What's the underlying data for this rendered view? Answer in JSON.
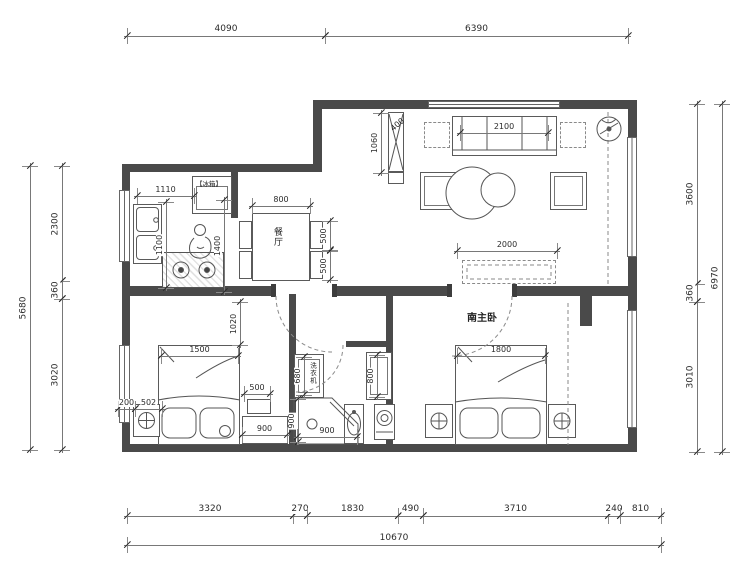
{
  "plan": {
    "type": "apartment-floor-plan",
    "labels": {
      "dining_room": "餐厅",
      "master_bedroom": "南主卧",
      "fridge": "【冰箱】",
      "washer": "洗衣机"
    },
    "dimension_chains": {
      "top": [
        "4090",
        "6390"
      ],
      "bottom_segments": [
        "3320",
        "270",
        "1830",
        "490",
        "3710",
        "240",
        "810"
      ],
      "bottom_total": "10670",
      "left_segments": [
        "2300",
        "360",
        "3020"
      ],
      "left_total": "5680",
      "right_segments": [
        "3600",
        "360",
        "3010"
      ],
      "right_total": "6970"
    },
    "interior_dimensions": [
      "1110",
      "1100",
      "1400",
      "800",
      "500",
      "500",
      "400",
      "1060",
      "2100",
      "2000",
      "1500",
      "1020",
      "200",
      "502",
      "500",
      "900",
      "1800",
      "680",
      "800",
      "900",
      "900"
    ]
  },
  "annotations": [
    {
      "id": "top-4090",
      "text": "4090",
      "type": "dh",
      "x": 127,
      "y": 36,
      "len": 198
    },
    {
      "id": "top-6390",
      "text": "6390",
      "type": "dh",
      "x": 325,
      "y": 36,
      "len": 303
    },
    {
      "id": "bottom-3320",
      "text": "3320",
      "type": "dh",
      "x": 127,
      "y": 516,
      "len": 166
    },
    {
      "id": "bottom-270",
      "text": "270",
      "type": "dh",
      "x": 293,
      "y": 516,
      "len": 14
    },
    {
      "id": "bottom-1830",
      "text": "1830",
      "type": "dh",
      "x": 307,
      "y": 516,
      "len": 91
    },
    {
      "id": "bottom-490",
      "text": "490",
      "type": "dh",
      "x": 398,
      "y": 516,
      "len": 25
    },
    {
      "id": "bottom-3710",
      "text": "3710",
      "type": "dh",
      "x": 423,
      "y": 516,
      "len": 185
    },
    {
      "id": "bottom-240",
      "text": "240",
      "type": "dh",
      "x": 608,
      "y": 516,
      "len": 12
    },
    {
      "id": "bottom-810",
      "text": "810",
      "type": "dh",
      "x": 620,
      "y": 516,
      "len": 41
    },
    {
      "id": "bottom-10670",
      "text": "10670",
      "type": "dh",
      "x": 127,
      "y": 545,
      "len": 534
    },
    {
      "id": "left-5680",
      "text": "5680",
      "type": "dv",
      "x": 30,
      "y": 166,
      "len": 284
    },
    {
      "id": "left-2300",
      "text": "2300",
      "type": "dv",
      "x": 62,
      "y": 166,
      "len": 115
    },
    {
      "id": "left-360",
      "text": "360",
      "type": "dv",
      "x": 62,
      "y": 281,
      "len": 18
    },
    {
      "id": "left-3020",
      "text": "3020",
      "type": "dv",
      "x": 62,
      "y": 299,
      "len": 151
    },
    {
      "id": "right-3600",
      "text": "3600",
      "type": "dv",
      "x": 697,
      "y": 104,
      "len": 180
    },
    {
      "id": "right-360",
      "text": "360",
      "type": "dv",
      "x": 697,
      "y": 284,
      "len": 18
    },
    {
      "id": "right-3010",
      "text": "3010",
      "type": "dv",
      "x": 697,
      "y": 302,
      "len": 150
    },
    {
      "id": "right-6970",
      "text": "6970",
      "type": "dv",
      "x": 722,
      "y": 104,
      "len": 348
    },
    {
      "id": "kitchen-1110",
      "text": "1110",
      "type": "dh",
      "x": 137,
      "y": 196,
      "len": 57,
      "small": true
    },
    {
      "id": "kitchen-1100",
      "text": "1100",
      "type": "dv",
      "x": 166,
      "y": 202,
      "len": 86,
      "small": true
    },
    {
      "id": "kitchen-1400",
      "text": "1400",
      "type": "dv",
      "x": 224,
      "y": 200,
      "len": 92,
      "small": true
    },
    {
      "id": "dining-800",
      "text": "800",
      "type": "dh",
      "x": 252,
      "y": 206,
      "len": 58,
      "small": true
    },
    {
      "id": "dining-500a",
      "text": "500",
      "type": "dv",
      "x": 330,
      "y": 221,
      "len": 29,
      "small": true
    },
    {
      "id": "dining-500b",
      "text": "500",
      "type": "dv",
      "x": 330,
      "y": 251,
      "len": 29,
      "small": true
    },
    {
      "id": "living-1060",
      "text": "1060",
      "type": "dv",
      "x": 381,
      "y": 113,
      "len": 60,
      "small": true
    },
    {
      "id": "living-400",
      "text": "400",
      "type": "label",
      "x": 390,
      "y": 121,
      "rot": -40,
      "small": true
    },
    {
      "id": "living-2100",
      "text": "2100",
      "type": "dh",
      "x": 460,
      "y": 133,
      "len": 88,
      "small": true
    },
    {
      "id": "living-2000",
      "text": "2000",
      "type": "dh",
      "x": 457,
      "y": 251,
      "len": 100,
      "small": true
    },
    {
      "id": "master-1800",
      "text": "1800",
      "type": "dh",
      "x": 457,
      "y": 356,
      "len": 88,
      "small": true
    },
    {
      "id": "bed1-1500",
      "text": "1500",
      "type": "dh",
      "x": 161,
      "y": 356,
      "len": 77,
      "small": true
    },
    {
      "id": "bed1-1020",
      "text": "1020",
      "type": "dv",
      "x": 240,
      "y": 302,
      "len": 43,
      "small": true
    },
    {
      "id": "bed1-200",
      "text": "200",
      "type": "dh",
      "x": 118,
      "y": 409,
      "len": 17,
      "small": true
    },
    {
      "id": "bed1-502",
      "text": "502",
      "type": "dh",
      "x": 135,
      "y": 409,
      "len": 27,
      "small": true
    },
    {
      "id": "bed1-500",
      "text": "500",
      "type": "dh",
      "x": 244,
      "y": 394,
      "len": 26,
      "small": true
    },
    {
      "id": "bed1-900",
      "text": "900",
      "type": "dh",
      "x": 242,
      "y": 435,
      "len": 45,
      "small": true
    },
    {
      "id": "bath-680",
      "text": "680",
      "type": "dv",
      "x": 304,
      "y": 357,
      "len": 38,
      "small": true
    },
    {
      "id": "bath-800",
      "text": "800",
      "type": "dv",
      "x": 377,
      "y": 355,
      "len": 42,
      "small": true
    },
    {
      "id": "bath-900v",
      "text": "900",
      "type": "dv",
      "x": 298,
      "y": 399,
      "len": 43,
      "small": true
    },
    {
      "id": "bath-900h",
      "text": "900",
      "type": "dh",
      "x": 297,
      "y": 437,
      "len": 60,
      "small": true
    },
    {
      "id": "label-dining",
      "text": "餐厅",
      "type": "label",
      "x": 272,
      "y": 227,
      "vertical": true
    },
    {
      "id": "label-master",
      "text": "南主卧",
      "type": "label",
      "x": 467,
      "y": 314,
      "bold": true
    },
    {
      "id": "label-fridge",
      "text": "【冰箱】",
      "type": "label",
      "x": 196,
      "y": 181,
      "tiny": true
    },
    {
      "id": "label-washer",
      "text": "洗衣机",
      "type": "label",
      "x": 309,
      "y": 362,
      "tiny": true,
      "vertical": true
    }
  ]
}
